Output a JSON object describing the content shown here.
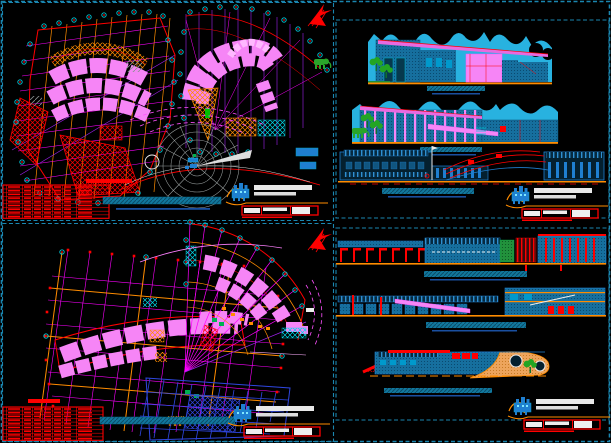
{
  "document": {
    "kind": "cad-drawing-sheet-preview",
    "background": "#000000",
    "palette": {
      "sheet_border_teal": "#1a86b0",
      "grid_magenta": "#ff00ff",
      "grid_orange": "#ff8c00",
      "grid_purple": "#a020f0",
      "outline_red": "#ff0000",
      "room_pink": "#f685f6",
      "roof_magenta": "#e86ae0",
      "column_bubble_teal": "#00c8d8",
      "sky_cyan": "#28b2e0",
      "building_blue_fill": "#166f9e",
      "line_drawing_blue": "#1f7fd0",
      "deep_grid_blue": "#2f46e0",
      "tree_green": "#23a523",
      "title_bar_teal": "#11789e",
      "title_text_blue": "#1a4fa0",
      "stamp_blue": "#1f7fd0",
      "stamp_white": "#e8e8e8",
      "plaza_gray": "#9aa0a0"
    },
    "sheets": [
      {
        "name": "lower-floor-plans-sheet",
        "position": "top-left",
        "drawings": [
          "west-wing-floor-plan",
          "east-wing-floor-plan",
          "radial-plaza-plan"
        ],
        "schedule_table": {
          "rows": 9,
          "columns": 7,
          "color": "#ff0000"
        },
        "title_bar": {
          "style": "teal-hatched"
        },
        "has_north_arrow": true,
        "has_title_block_stamp": true
      },
      {
        "name": "color-elevations-sheet",
        "position": "top-right",
        "drawings": [
          "front-color-elevation",
          "rear-color-elevation",
          "lateral-line-elevation"
        ],
        "title_bars": 3,
        "has_title_block_stamp": true,
        "scenery": [
          "mountain-silhouette",
          "pagoda-roof-silhouette",
          "trees",
          "elephant"
        ]
      },
      {
        "name": "upper-floor-plans-sheet",
        "position": "bottom-left",
        "drawings": [
          "west-wing-upper-plan",
          "east-wing-fan-plan"
        ],
        "schedule_table": {
          "rows": 9,
          "columns": 7,
          "color": "#ff0000"
        },
        "title_bar": {
          "style": "teal-hatched"
        },
        "has_north_arrow": true,
        "has_title_block_stamp": true
      },
      {
        "name": "sections-sheet",
        "position": "bottom-right",
        "drawings": [
          "longitudinal-section-a",
          "longitudinal-section-b",
          "partial-section-c"
        ],
        "title_bars": 3,
        "has_title_block_stamp": true
      }
    ],
    "icons": [
      "north-arrow-icon",
      "tree-icon",
      "elephant-icon",
      "fountain-icon",
      "temple-stamp-icon"
    ]
  }
}
